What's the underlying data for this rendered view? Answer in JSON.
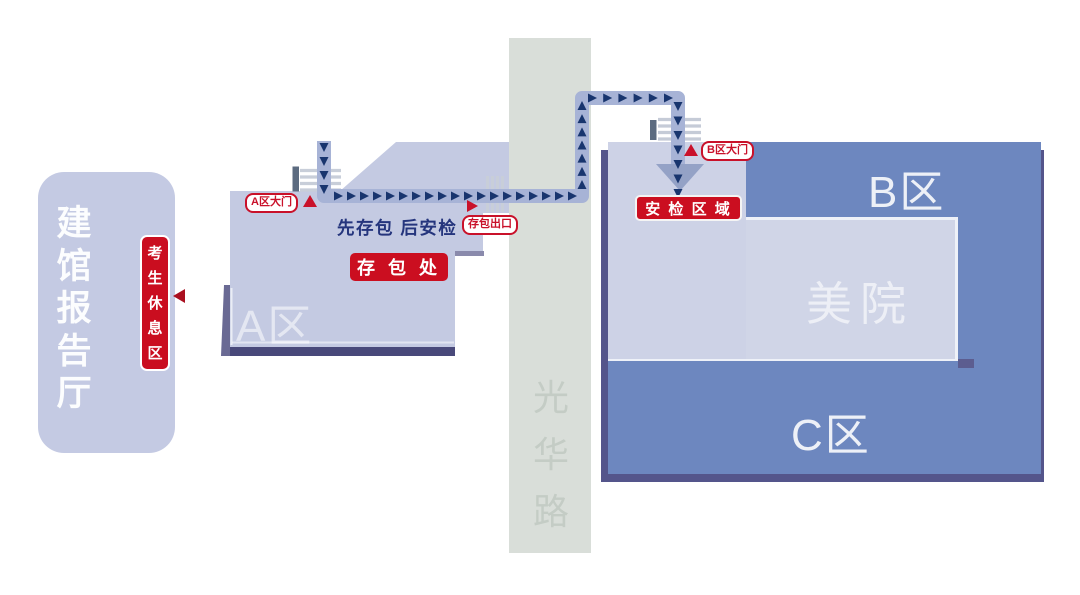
{
  "map": {
    "left_building": {
      "name": "建馆报告厅",
      "rest_badge": "考生休息区"
    },
    "zone_a": {
      "name": "A区",
      "gate_badge": "A区大门",
      "instruction": "先存包 后安检",
      "bag_storage_badge": "存 包 处",
      "bag_exit_badge": "存包出口"
    },
    "road": {
      "name": "光华路"
    },
    "zone_b": {
      "name": "B区",
      "gate_badge": "B区大门",
      "security_badge": "安 检 区 域"
    },
    "zone_c": {
      "name": "C区"
    },
    "academy": {
      "name": "美院"
    }
  },
  "colors": {
    "building_lavender": "#c4cae2",
    "entry_lavender": "#cdd2e6",
    "academy_lavender": "#d0d5e7",
    "block_blue": "#6d87bf",
    "shadow_navy": "#54558b",
    "road_gray": "#d9ded9",
    "route_band": "#a7b3d6",
    "route_arrow": "#18356e",
    "badge_red": "#cb0e20",
    "instruction_navy": "#25357d"
  }
}
